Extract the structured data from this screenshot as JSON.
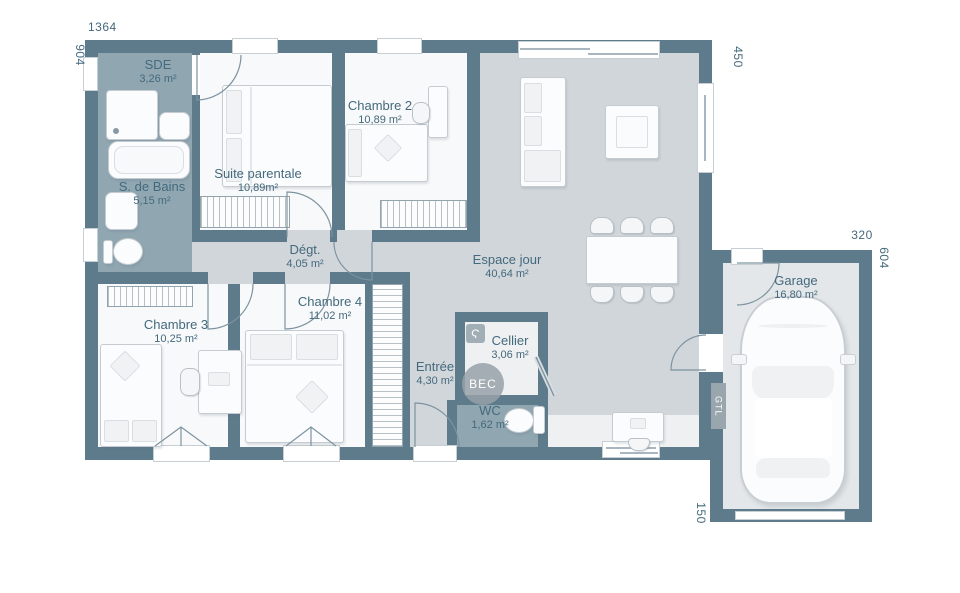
{
  "rooms": [
    {
      "name": "SDE",
      "area": "3,26 m²"
    },
    {
      "name": "Suite parentale",
      "area": "10,89m²"
    },
    {
      "name": "Chambre 2",
      "area": "10,89 m²"
    },
    {
      "name": "S. de Bains",
      "area": "5,15 m²"
    },
    {
      "name": "Dégt.",
      "area": "4,05 m²"
    },
    {
      "name": "Espace jour",
      "area": "40,64 m²"
    },
    {
      "name": "Chambre 3",
      "area": "10,25 m²"
    },
    {
      "name": "Chambre 4",
      "area": "11,02 m²"
    },
    {
      "name": "Entrée",
      "area": "4,30 m²"
    },
    {
      "name": "Cellier",
      "area": "3,06 m²"
    },
    {
      "name": "WC",
      "area": "1,62 m²"
    },
    {
      "name": "Garage",
      "area": "16,80 m²"
    }
  ],
  "dimensions": {
    "top": "1364",
    "left": "904",
    "main_right": "450",
    "garage_top": "320",
    "garage_right": "604",
    "garage_bottom": "150"
  },
  "labels": {
    "bec": "BEC",
    "gtl": "GTL",
    "water_heater_icon": "Ϛ"
  },
  "colors": {
    "wall": "#5d7b8a",
    "floor_main": "#d1d6da",
    "floor_wet": "#90a7b2",
    "floor_room": "#f8f9fa",
    "floor_light": "#eef0f1",
    "floor_garage": "#e4e7e9",
    "text": "#44697d"
  }
}
